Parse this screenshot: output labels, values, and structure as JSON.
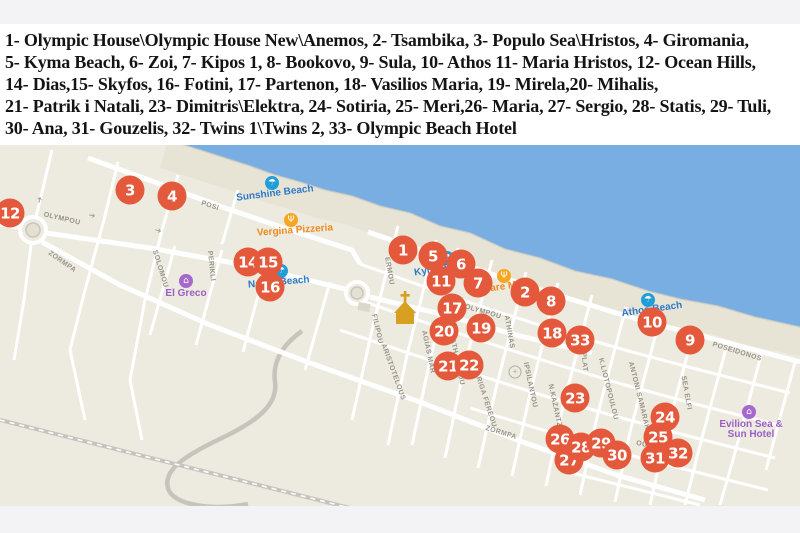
{
  "legend": {
    "lines": [
      "1- Olympic House\\Olympic House New\\Anemos, 2- Tsambika, 3- Populo Sea\\Hristos, 4- Giromania,",
      "5- Kyma Beach, 6- Zoi, 7- Kipos 1, 8- Bookovo, 9- Sula, 10- Athos 11- Maria Hristos, 12- Ocean Hills,",
      "14- Dias,15- Skyfos, 16- Fotini, 17- Partenon, 18- Vasilios Maria, 19- Mirela,20- Mihalis,",
      "21- Patrik i Natali, 23- Dimitris\\Elektra, 24- Sotiria, 25- Meri,26- Maria, 27- Sergio, 28- Statis, 29- Tuli,",
      "30- Ana, 31- Gouzelis, 32- Twins 1\\Twins 2, 33- Olympic Beach Hotel"
    ]
  },
  "map": {
    "colors": {
      "sea": "#79aee3",
      "land": "#edeadf",
      "beach": "#e8e4d5",
      "marker": "#e4593b",
      "beach_label": "#2d79c8",
      "food_label": "#ee8a1f",
      "hotel_label": "#9a5fc6"
    },
    "markers": [
      {
        "n": "1",
        "x": 403,
        "y": 250
      },
      {
        "n": "2",
        "x": 525,
        "y": 292
      },
      {
        "n": "3",
        "x": 130,
        "y": 190
      },
      {
        "n": "4",
        "x": 172,
        "y": 196
      },
      {
        "n": "5",
        "x": 433,
        "y": 256
      },
      {
        "n": "6",
        "x": 461,
        "y": 264
      },
      {
        "n": "7",
        "x": 478,
        "y": 283
      },
      {
        "n": "8",
        "x": 551,
        "y": 301
      },
      {
        "n": "9",
        "x": 690,
        "y": 340
      },
      {
        "n": "10",
        "x": 652,
        "y": 322
      },
      {
        "n": "11",
        "x": 441,
        "y": 281
      },
      {
        "n": "12",
        "x": 10,
        "y": 213
      },
      {
        "n": "14",
        "x": 248,
        "y": 262
      },
      {
        "n": "15",
        "x": 268,
        "y": 262
      },
      {
        "n": "16",
        "x": 270,
        "y": 287
      },
      {
        "n": "17",
        "x": 452,
        "y": 308
      },
      {
        "n": "18",
        "x": 552,
        "y": 333
      },
      {
        "n": "19",
        "x": 481,
        "y": 328
      },
      {
        "n": "20",
        "x": 444,
        "y": 331
      },
      {
        "n": "21",
        "x": 448,
        "y": 366
      },
      {
        "n": "22",
        "x": 469,
        "y": 365
      },
      {
        "n": "23",
        "x": 575,
        "y": 398
      },
      {
        "n": "24",
        "x": 665,
        "y": 417
      },
      {
        "n": "25",
        "x": 658,
        "y": 437
      },
      {
        "n": "26",
        "x": 560,
        "y": 439
      },
      {
        "n": "27",
        "x": 569,
        "y": 460
      },
      {
        "n": "28",
        "x": 581,
        "y": 447
      },
      {
        "n": "29",
        "x": 601,
        "y": 443
      },
      {
        "n": "30",
        "x": 617,
        "y": 455
      },
      {
        "n": "31",
        "x": 655,
        "y": 458
      },
      {
        "n": "32",
        "x": 678,
        "y": 453
      },
      {
        "n": "33",
        "x": 580,
        "y": 340
      }
    ],
    "pois": [
      {
        "type": "beach",
        "label": "Sunshine Beach",
        "ix": 272,
        "iy": 183,
        "tx": 275,
        "ty": 194,
        "r": -7
      },
      {
        "type": "food",
        "label": "Vergina Pizzeria",
        "ix": 291,
        "iy": 220,
        "tx": 295,
        "ty": 231,
        "r": -4
      },
      {
        "type": "beach",
        "label": "Kyma Beach",
        "ix": 447,
        "iy": 258,
        "tx": 414,
        "ty": 269,
        "r": -9,
        "anchor": "left"
      },
      {
        "type": "beach",
        "label": "Natrol Beach",
        "ix": 281,
        "iy": 271,
        "tx": 248,
        "ty": 283,
        "r": -5,
        "anchor": "left"
      },
      {
        "type": "food",
        "label": "Mare Mare",
        "ix": 504,
        "iy": 276,
        "tx": 482,
        "ty": 287,
        "r": -8,
        "anchor": "left"
      },
      {
        "type": "beach",
        "label": "Athos Beach",
        "ix": 648,
        "iy": 300,
        "tx": 652,
        "ty": 310,
        "r": -8
      },
      {
        "type": "hotel",
        "label": "El Greco",
        "ix": 186,
        "iy": 281,
        "tx": 186,
        "ty": 294,
        "r": 0
      },
      {
        "type": "hotel",
        "label": "Evilion Sea &",
        "label2": "Sun Hotel",
        "ix": 749,
        "iy": 412,
        "tx": 751,
        "ty": 430,
        "r": 0
      },
      {
        "type": "gas",
        "label": "",
        "ix": 515,
        "iy": 372,
        "tx": 515,
        "ty": 372,
        "r": 0
      }
    ],
    "icon_glyphs": {
      "beach": "☂",
      "food": "Ψ",
      "hotel": "⌂",
      "gas": "+"
    },
    "street_labels": [
      {
        "t": "OLYMPOU",
        "x": 62,
        "y": 219,
        "r": 13
      },
      {
        "t": "OLYMPOU",
        "x": 483,
        "y": 312,
        "r": 16
      },
      {
        "t": "ZORMPA",
        "x": 62,
        "y": 262,
        "r": 35
      },
      {
        "t": "ZORMPA",
        "x": 501,
        "y": 433,
        "r": 17
      },
      {
        "t": "POSI",
        "x": 210,
        "y": 206,
        "r": 18
      },
      {
        "t": "POSEIDONOS",
        "x": 737,
        "y": 352,
        "r": 17
      },
      {
        "t": "SOLOMOU",
        "x": 160,
        "y": 269,
        "r": 73
      },
      {
        "t": "PERIKLI",
        "x": 211,
        "y": 266,
        "r": 84
      },
      {
        "t": "FILIPOU",
        "x": 377,
        "y": 329,
        "r": 77
      },
      {
        "t": "ARISTOTELOUS",
        "x": 393,
        "y": 372,
        "r": 70
      },
      {
        "t": "ERMOU",
        "x": 389,
        "y": 271,
        "r": 80
      },
      {
        "t": "AGIAS MAR",
        "x": 428,
        "y": 352,
        "r": 78
      },
      {
        "t": "ATH.DIAKOU",
        "x": 457,
        "y": 362,
        "r": 78
      },
      {
        "t": "ATHINAS",
        "x": 509,
        "y": 332,
        "r": 80
      },
      {
        "t": "PLAT",
        "x": 584,
        "y": 362,
        "r": 85
      },
      {
        "t": "K.LIOTOPOULOU",
        "x": 608,
        "y": 389,
        "r": 76
      },
      {
        "t": "ANTONI SAMARAKI",
        "x": 639,
        "y": 397,
        "r": 76
      },
      {
        "t": "SEA ELFI",
        "x": 686,
        "y": 393,
        "r": 80
      },
      {
        "t": "IPSILANTOU",
        "x": 530,
        "y": 385,
        "r": 78
      },
      {
        "t": "RIGA FEREOU",
        "x": 486,
        "y": 402,
        "r": 72
      },
      {
        "t": "N.KAZANTZAKI",
        "x": 556,
        "y": 412,
        "r": 78
      },
      {
        "t": "OUT",
        "x": 644,
        "y": 445,
        "r": 12
      }
    ],
    "arrows": [
      {
        "x": 92,
        "y": 216,
        "r": 12
      },
      {
        "x": 158,
        "y": 231,
        "r": 14
      },
      {
        "x": 40,
        "y": 200,
        "r": -78
      }
    ]
  }
}
